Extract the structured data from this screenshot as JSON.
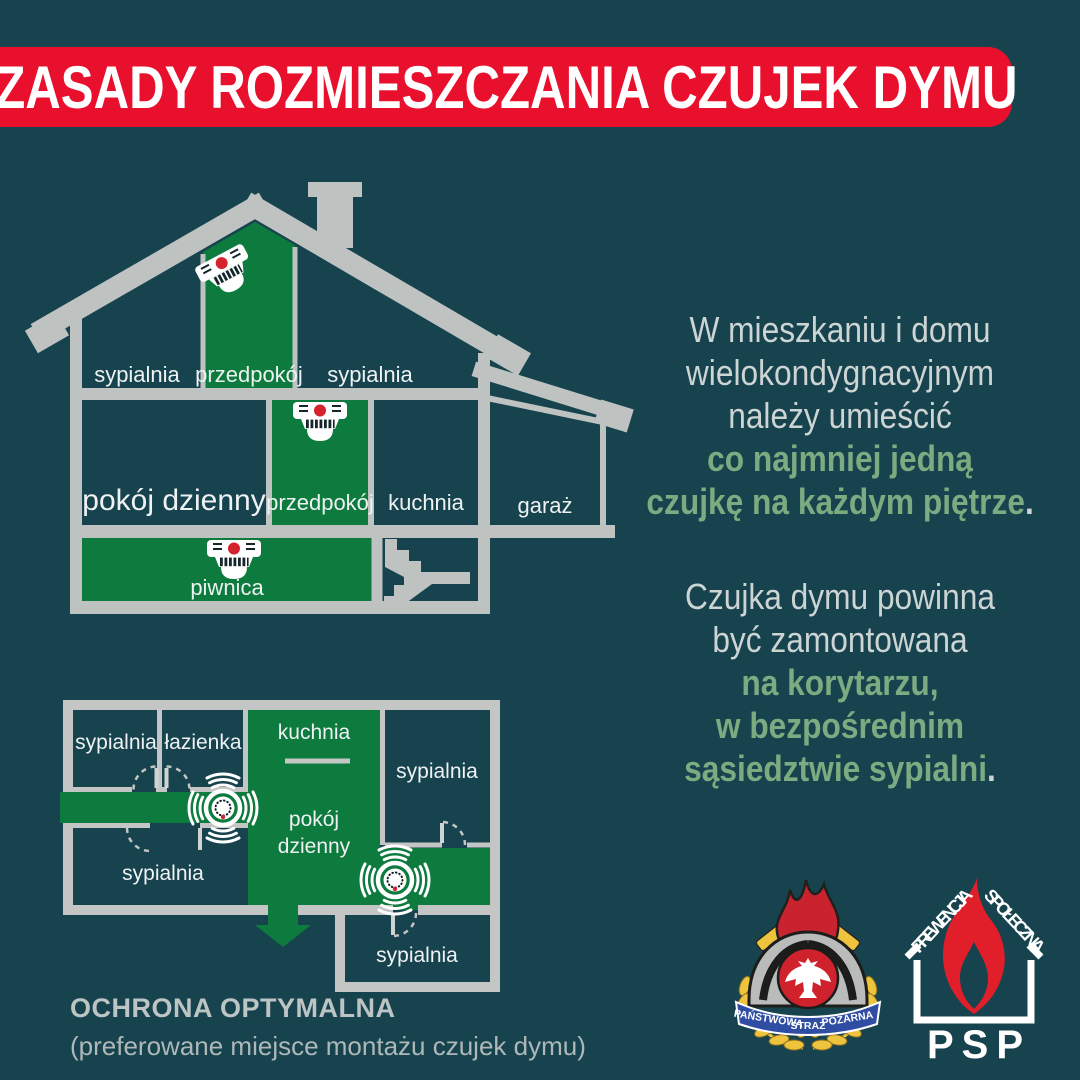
{
  "banner": {
    "title": "ZASADY ROZMIESZCZANIA CZUJEK DYMU"
  },
  "house": {
    "rooms": [
      "sypialnia",
      "przedpokój",
      "sypialnia",
      "pokój dzienny",
      "przedpokój",
      "kuchnia",
      "garaż",
      "piwnica"
    ]
  },
  "plan": {
    "rooms": [
      "sypialnia",
      "łazienka",
      "kuchnia",
      "sypialnia",
      "pokój",
      "dzienny",
      "sypialnia",
      "sypialnia"
    ]
  },
  "info": {
    "p1": {
      "gray": [
        "W mieszkaniu i domu",
        "wielokondygnacyjnym",
        "należy umieścić"
      ],
      "green": [
        "co najmniej jedną",
        "czujkę na każdym piętrze"
      ],
      "period": "."
    },
    "p2": {
      "gray": [
        "Czujka dymu powinna",
        "być zamontowana"
      ],
      "green": [
        "na korytarzu,",
        "w bezpośrednim",
        "sąsiedztwie sypialni"
      ],
      "period": "."
    }
  },
  "caption": {
    "title": "OCHRONA OPTYMALNA",
    "subtitle": "(preferowane miejsce montażu czujek dymu)"
  },
  "logos": {
    "crest": {
      "ribbon": [
        "PAŃSTWOWA",
        "STRAŻ",
        "POŻARNA"
      ]
    },
    "prevention": {
      "left": "PREWENCJA",
      "right": "SPOŁECZNA",
      "name": "PSP"
    }
  },
  "colors": {
    "background": "#17434e",
    "room_green": "#0d7a3e",
    "text_green": "#7cab81",
    "banner_red": "#e8102c",
    "wall_gray": "#bec2c1",
    "text_gray": "#cdd4d4"
  }
}
